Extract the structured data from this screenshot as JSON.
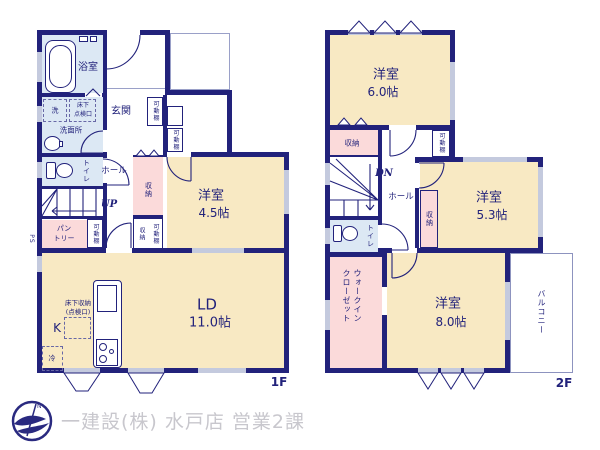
{
  "labels": {
    "western_room": "洋室",
    "storage": "収納",
    "movable_shelf": "可動棚",
    "toilet": "トイレ",
    "hall": "ホール"
  },
  "floor1": {
    "bathroom": "浴室",
    "washer": "洗",
    "hatch_line1": "床下",
    "hatch_line2": "点検口",
    "washroom": "洗面所",
    "entrance": "玄関",
    "up": "UP",
    "ps": "PS",
    "pantry_line1": "パン",
    "pantry_line2": "トリー",
    "room45_size": "4.5帖",
    "ld": "LD",
    "ld_size": "11.0帖",
    "kitchen": "K",
    "fridge": "冷",
    "underfloor_line1": "床下収納",
    "underfloor_line2": "(点検口)",
    "floor_tag": "1F"
  },
  "floor2": {
    "room60_size": "6.0帖",
    "room53_size": "5.3帖",
    "room80_size": "8.0帖",
    "dn": "DN",
    "wic_line1": "ウォークイン",
    "wic_line2": "クローゼット",
    "balcony": "バルコニー",
    "floor_tag": "2F"
  },
  "footer": {
    "company": "一建設(株) 水戸店 営業2課",
    "logo_n": "N"
  },
  "colors": {
    "wall": "#22227b",
    "room_cream": "#f8e9c3",
    "closet_pink": "#fbdada",
    "wet_blue": "#dce8f4",
    "window_gray": "#c4cade",
    "footer_text": "#c8c7cd"
  }
}
